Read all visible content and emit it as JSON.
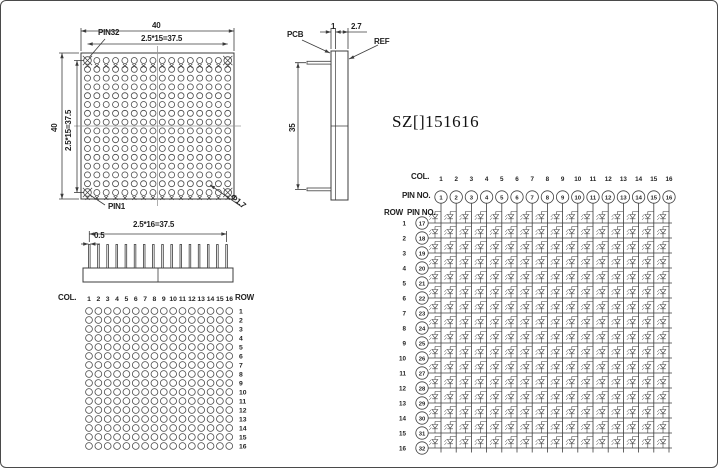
{
  "title": "SZ[]151616",
  "front_view": {
    "dim_width": "40",
    "pitch_h": "2.5*15=37.5",
    "dim_height": "40",
    "pitch_v": "2.5*15=37.5",
    "pin32": "PIN32",
    "pin1": "PIN1",
    "hole_dia": "Φ1.7"
  },
  "side_view": {
    "pcb": "PCB",
    "thickness": "1",
    "total_thickness": "2.7",
    "ref": "REF",
    "height": "35"
  },
  "pin_view": {
    "pitch": "2.5*16=37.5",
    "pin_width": "0.5"
  },
  "dot_map": {
    "col_label": "COL.",
    "row_label": "ROW",
    "cols": [
      "1",
      "2",
      "3",
      "4",
      "5",
      "6",
      "7",
      "8",
      "9",
      "10",
      "11",
      "12",
      "13",
      "14",
      "15",
      "16"
    ],
    "rows": [
      "1",
      "2",
      "3",
      "4",
      "5",
      "6",
      "7",
      "8",
      "9",
      "10",
      "11",
      "12",
      "13",
      "14",
      "15",
      "16"
    ]
  },
  "schematic": {
    "col_label": "COL.",
    "col_pin_label": "PIN NO.",
    "row_label": "ROW",
    "row_pin_label": "PIN NO.",
    "cols": [
      "1",
      "2",
      "3",
      "4",
      "5",
      "6",
      "7",
      "8",
      "9",
      "10",
      "11",
      "12",
      "13",
      "14",
      "15",
      "16"
    ],
    "col_pins": [
      "1",
      "2",
      "3",
      "4",
      "5",
      "6",
      "7",
      "8",
      "9",
      "10",
      "11",
      "12",
      "13",
      "14",
      "15",
      "16"
    ],
    "rows": [
      "1",
      "2",
      "3",
      "4",
      "5",
      "6",
      "7",
      "8",
      "9",
      "10",
      "11",
      "12",
      "13",
      "14",
      "15",
      "16"
    ],
    "row_pins": [
      "17",
      "18",
      "19",
      "20",
      "21",
      "22",
      "23",
      "24",
      "25",
      "26",
      "27",
      "28",
      "29",
      "30",
      "31",
      "32"
    ]
  },
  "colors": {
    "line": "#3c3c3c",
    "centerline": "#9a9a9a",
    "text": "#1f1f1f"
  }
}
